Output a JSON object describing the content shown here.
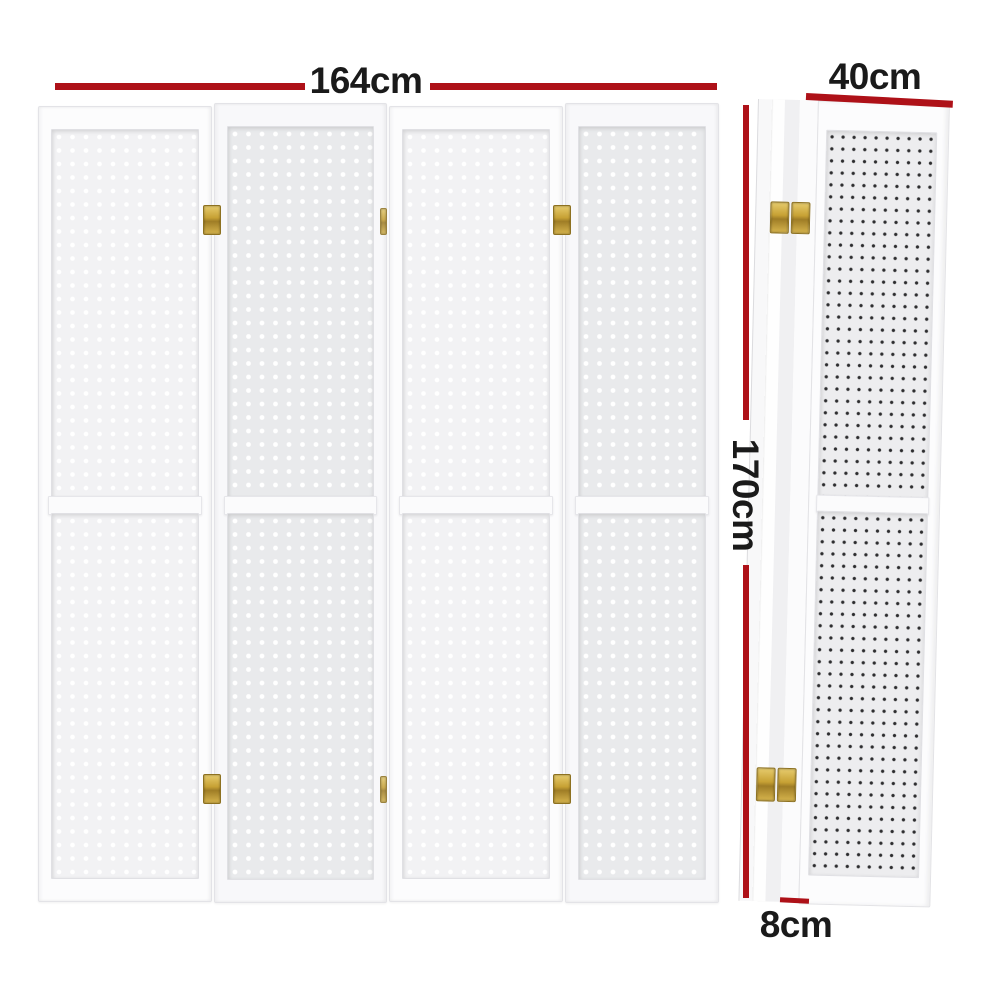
{
  "diagram": {
    "kind": "room-divider-dimension-diagram",
    "views": {
      "front": {
        "panel_count": 4
      },
      "side": {
        "folded": true
      }
    },
    "labels": {
      "width": "164cm",
      "height": "170cm",
      "depth": "40cm",
      "thickness": "8cm"
    },
    "colors": {
      "dimension_line": "#ae1118",
      "label_text": "#1a1a1a",
      "hinge_brass": "#c7a134",
      "panel_white": "#fcfcfd",
      "pegboard_back": "#e9eaec",
      "pegboard_front": "#f2f2f4"
    }
  }
}
